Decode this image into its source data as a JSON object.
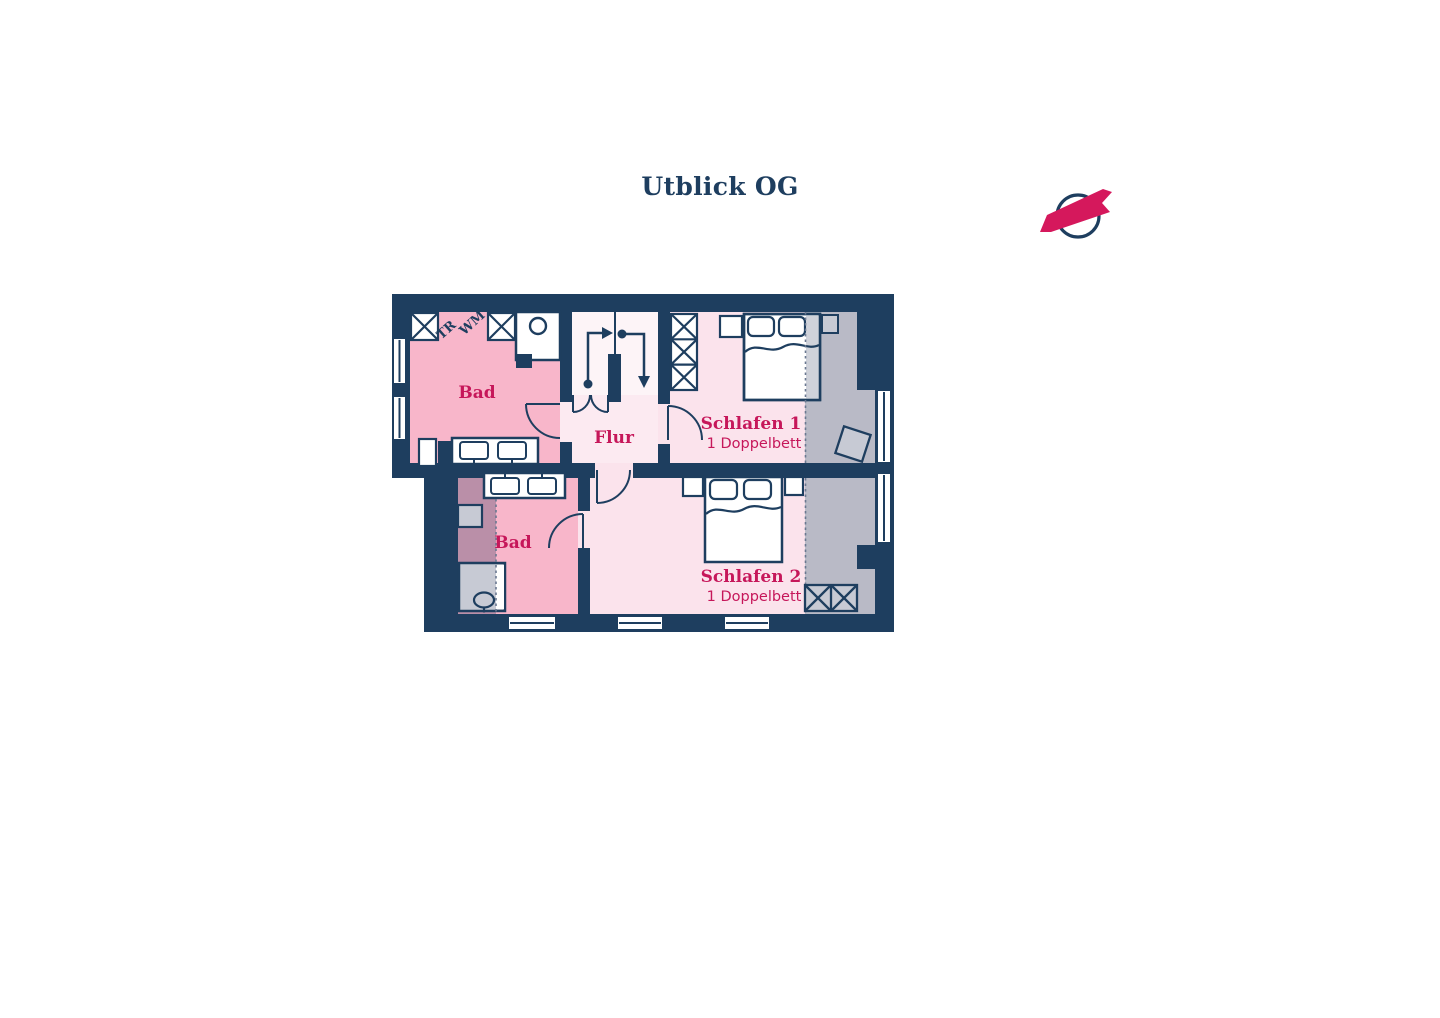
{
  "page": {
    "title": "Utblick OG"
  },
  "rooms": {
    "bad1": {
      "label": "Bad"
    },
    "bad2": {
      "label": "Bad"
    },
    "flur": {
      "label": "Flur"
    },
    "schlafen1": {
      "label": "Schlafen 1",
      "beds": "1 Doppelbett"
    },
    "schlafen2": {
      "label": "Schlafen 2",
      "beds": "1 Doppelbett"
    }
  },
  "laundry": {
    "washer": "WM",
    "dryer": "TR"
  },
  "icons": {
    "compass": "north-compass-arrow",
    "stairs_up": "stairs-up-arrow",
    "stairs_down": "stairs-down-arrow"
  },
  "colors": {
    "wall-navy": "#1e3e5f",
    "bath-pink": "#f8b6ca",
    "room-pink": "#fbe3ec",
    "flur-pink": "#fceaf1",
    "stairs-pink": "#fdf4f7",
    "slope-gray": "#b9bac6",
    "object-gray": "#c7cad4",
    "slope-mauve": "#ba8fa8",
    "dash-gray": "#6a7890",
    "label-crimson": "#c6175a",
    "compass-crimson": "#d5185c"
  }
}
